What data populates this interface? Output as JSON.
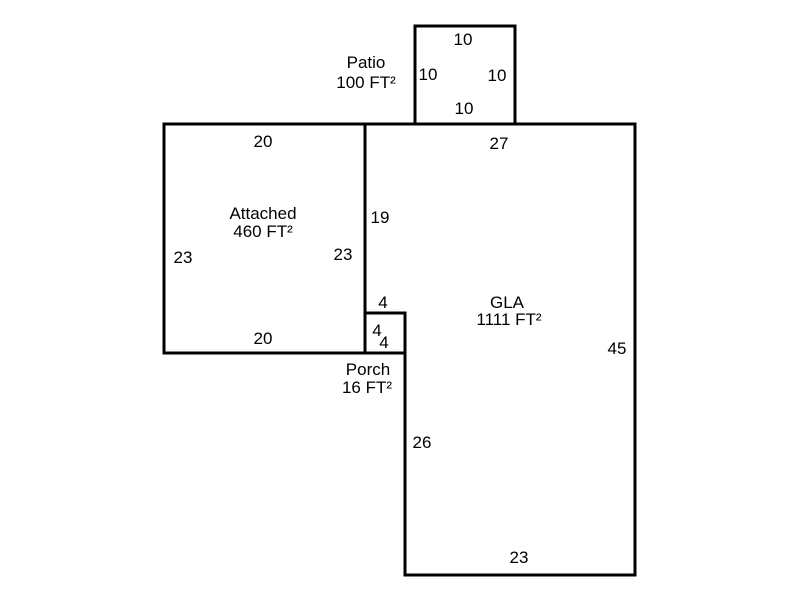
{
  "colors": {
    "background": "#ffffff",
    "line": "#000000",
    "text": "#000000"
  },
  "areas": {
    "patio": {
      "label": "Patio",
      "area": "100 FT²",
      "dims": {
        "top": "10",
        "left": "10",
        "right": "10",
        "bottom": "10"
      }
    },
    "attached": {
      "label": "Attached",
      "area": "460 FT²",
      "dims": {
        "top": "20",
        "left": "23",
        "right": "23",
        "bottom": "20"
      }
    },
    "gla": {
      "label": "GLA",
      "area": "1111 FT²",
      "dims": {
        "top": "27",
        "left_upper": "19",
        "notch": "4",
        "right": "45",
        "left_lower": "26",
        "bottom": "23"
      }
    },
    "porch": {
      "label": "Porch",
      "area": "16 FT²",
      "dims": {
        "left": "4",
        "bottom": "4"
      }
    }
  }
}
